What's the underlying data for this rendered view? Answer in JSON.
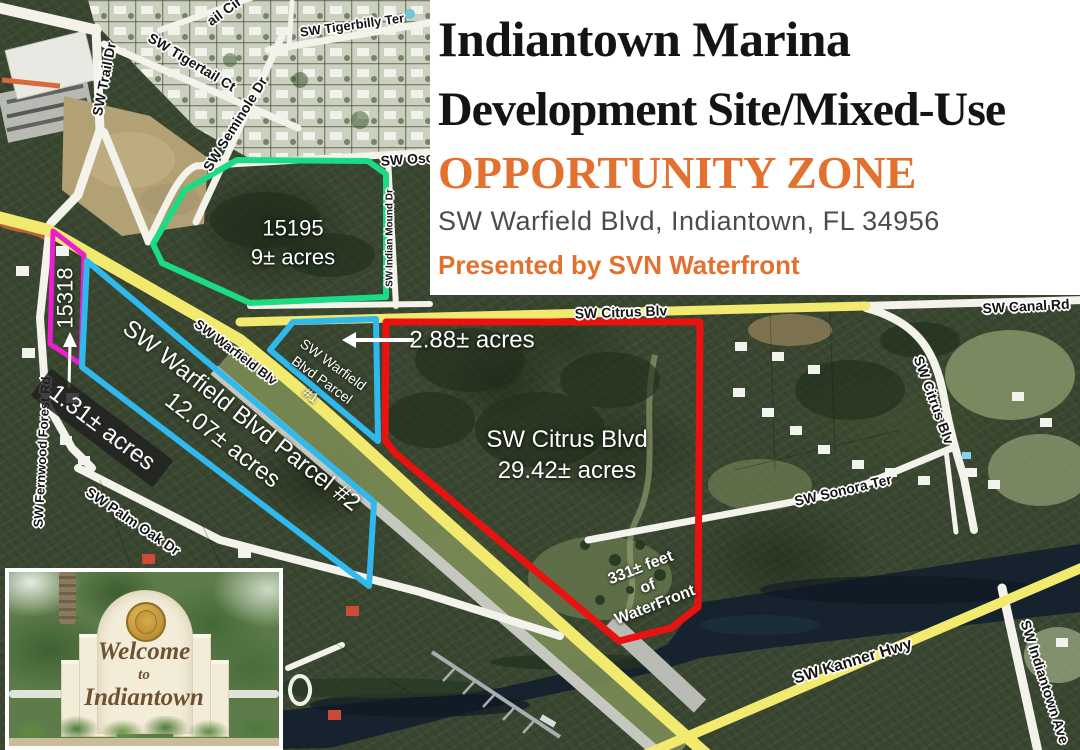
{
  "header": {
    "title_line1": "Indiantown Marina",
    "title_line2": "Development Site/Mixed-Use",
    "title_line3": "OPPORTUNITY ZONE",
    "address": "SW Warfield Blvd, Indiantown, FL 34956",
    "presented_by": "Presented by SVN Waterfront",
    "accent_color": "#e2702e",
    "title_color": "#141414"
  },
  "parcels": {
    "osceola_green": {
      "outline_color": "#1bdc82",
      "lines": [
        "15195",
        "9± acres"
      ]
    },
    "parcel_15318_magenta": {
      "outline_color": "#ec1ece",
      "id_label": "15318",
      "acres_label": "1.31± acres"
    },
    "warfield_parcel_1_blue": {
      "outline_color": "#2fb9ec",
      "lines": [
        "SW Warfield",
        "Blvd Parcel",
        "#1"
      ],
      "acres_label": "2.88± acres"
    },
    "warfield_parcel_2_blue": {
      "outline_color": "#2fb9ec",
      "lines": [
        "SW Warfield Blvd Parcel #2",
        "12.07± acres"
      ]
    },
    "citrus_red": {
      "outline_color": "#ea1111",
      "lines": [
        "SW Citrus Blvd",
        "29.42± acres"
      ],
      "waterfront_lines": [
        "331± feet",
        "of",
        "WaterFront"
      ]
    }
  },
  "road_labels": {
    "trail_cir": "ail Cir",
    "tigerbilly": "SW Tigerbilly Ter",
    "tigertail": "SW Tigertail Ct",
    "trail_dr": "SW Trail Dr",
    "seminole": "SW Seminole Dr",
    "osceola": "SW Osc",
    "indian_mound": "SW Indian Mound Dr",
    "warfield": "SW Warfield Blv",
    "citrus_h": "SW Citrus Blv",
    "canal": "SW Canal Rd",
    "citrus_v": "SW Citrus Blv",
    "sonora": "SW Sonora Ter",
    "fernwood": "SW Fernwood Forest Rd",
    "palm_oak": "SW Palm Oak Dr",
    "kanner": "SW Kanner Hwy",
    "indiantown_ave": "SW Indiantown Ave"
  },
  "inset_sign": {
    "line1": "Welcome",
    "line2": "to",
    "line3": "Indiantown"
  },
  "map_colors": {
    "road_yellow": "#f2e96f",
    "water": "#16222e"
  }
}
